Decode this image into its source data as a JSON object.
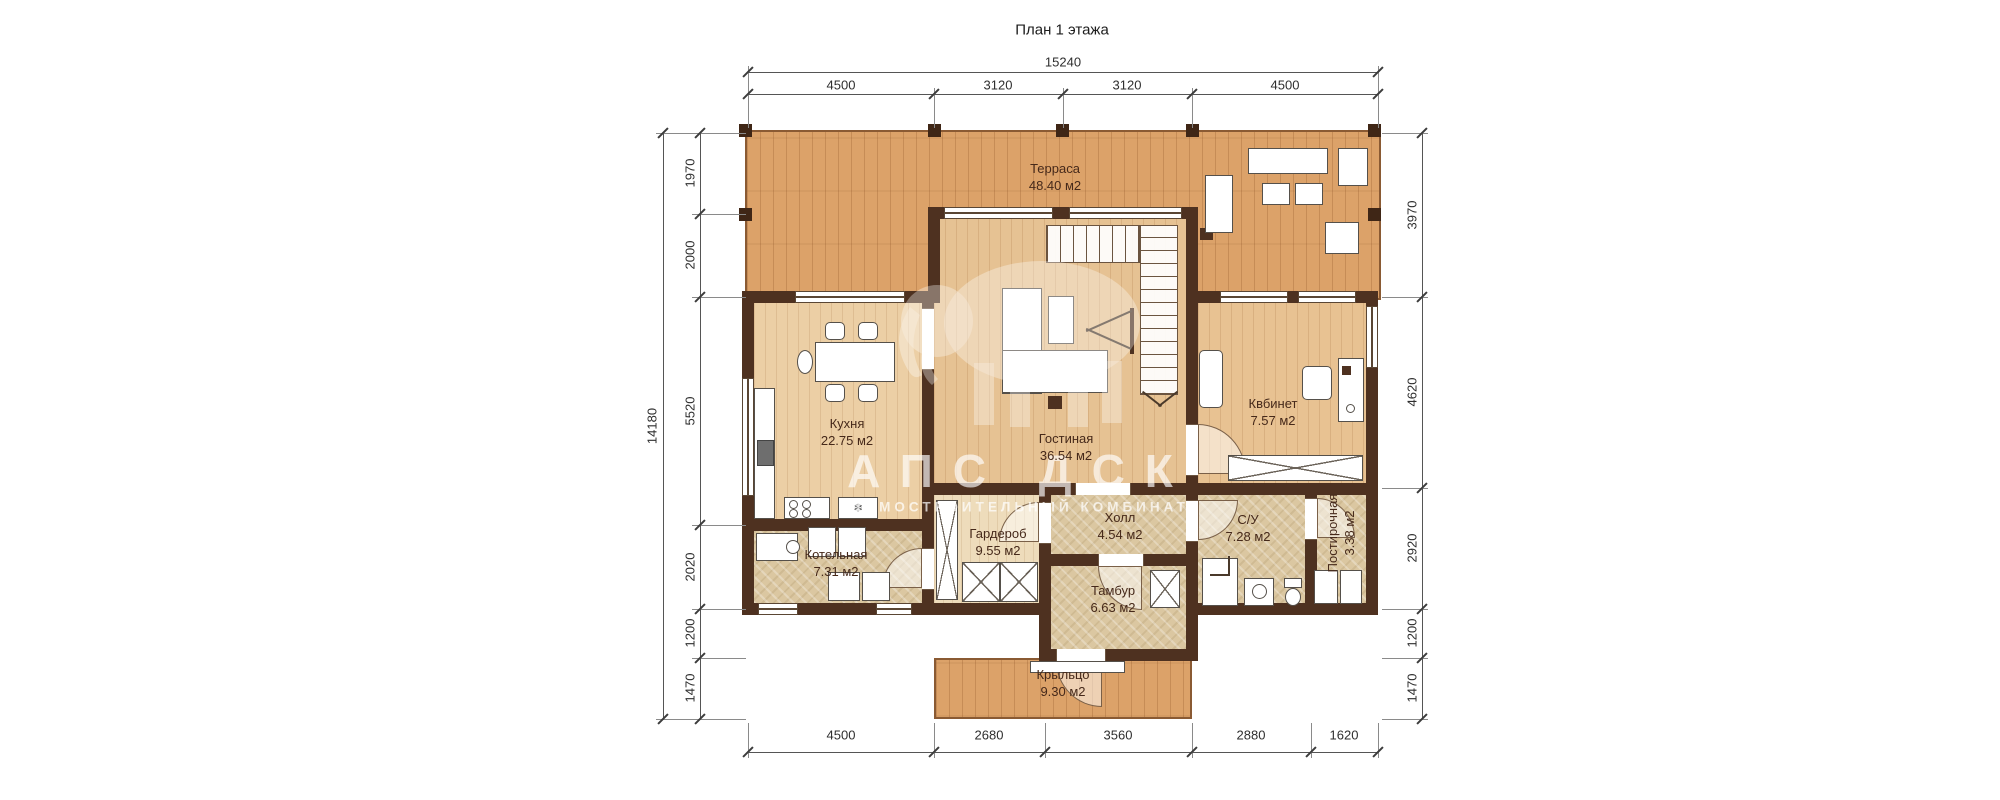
{
  "title": "План 1 этажа",
  "watermark": {
    "line1": "АПС ДСК",
    "line2": "ДОМОСТРОИТЕЛЬНЫЙ КОМБИНАТ"
  },
  "rooms": {
    "terrace": {
      "name": "Терраса",
      "area": "48.40 м2"
    },
    "kitchen": {
      "name": "Кухня",
      "area": "22.75 м2"
    },
    "living": {
      "name": "Гостиная",
      "area": "36.54 м2"
    },
    "cabinet": {
      "name": "Квбинет",
      "area": "7.57 м2"
    },
    "wardrobe": {
      "name": "Гардероб",
      "area": "9.55 м2"
    },
    "hall": {
      "name": "Холл",
      "area": "4.54 м2"
    },
    "bathroom": {
      "name": "С/У",
      "area": "7.28 м2"
    },
    "laundry": {
      "name": "Постирочная",
      "area": "3.38 м2"
    },
    "boiler": {
      "name": "Котельная",
      "area": "7.31 м2"
    },
    "vestibule": {
      "name": "Тамбур",
      "area": "6.63 м2"
    },
    "porch": {
      "name": "Крыльцо",
      "area": "9.30 м2"
    }
  },
  "dims": {
    "top_total": "15240",
    "top_segments": [
      "4500",
      "3120",
      "3120",
      "4500"
    ],
    "bottom_segments": [
      "4500",
      "2680",
      "3560",
      "2880",
      "1620"
    ],
    "left_total": "14180",
    "left_segments": [
      "1970",
      "2000",
      "5520",
      "2020",
      "1200",
      "1470"
    ],
    "right_segments": [
      "3970",
      "4620",
      "2920",
      "1200",
      "1470"
    ]
  },
  "icons": {
    "fridge": "❄",
    "snow_label": "❄"
  },
  "colors": {
    "wall": "#4e3120",
    "deck": "#dca269",
    "interior_wood": "#eccfa5",
    "tile": "#dbc7a1",
    "dim_line": "#555555"
  }
}
